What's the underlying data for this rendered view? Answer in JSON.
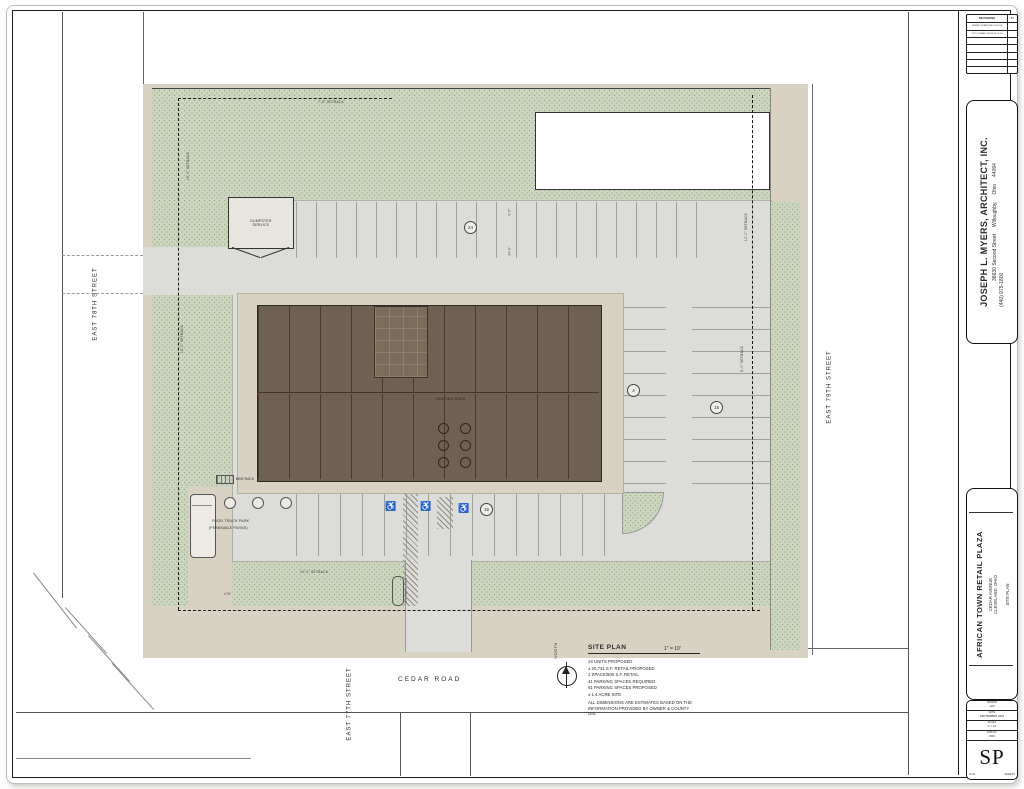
{
  "revisions": {
    "title": "REVISIONS",
    "by": "BY",
    "rows": [
      "PERMIT SUBMITTAL 01.05.24",
      "CITY CORRECTIONS 02.10.24",
      "",
      "",
      "",
      "",
      ""
    ]
  },
  "architect": {
    "name": "JOSEPH L. MYERS, ARCHITECT, INC.",
    "street": "38630 Second Street",
    "city": "Willoughby,",
    "state": "Ohio",
    "zip": "44094",
    "phone": "(440) 975-1800"
  },
  "project": {
    "name": "AFRICAN TOWN RETAIL PLAZA",
    "addr1": "CEDAR AVENUE",
    "addr2": "CLEVELAND, OHIO",
    "sheet_title": "SITE PLAN"
  },
  "sheetblock": {
    "rows": [
      {
        "label": "DRAWN",
        "value": "JLM"
      },
      {
        "label": "DATE",
        "value": "SEPTEMBER 2023"
      },
      {
        "label": "SCALE",
        "value": "1\" = 10'"
      },
      {
        "label": "JOB NO.",
        "value": "2310"
      }
    ],
    "number": "SP",
    "footer_left": "01 01",
    "footer_right": "SHEETS"
  },
  "plan": {
    "streets": {
      "left": "EAST 78TH STREET",
      "right": "EAST 79TH STREET",
      "south": "EAST 77TH STREET",
      "bottom": "CEDAR ROAD"
    },
    "labels": {
      "dumpster1": "DUMPSTER",
      "dumpster2": "SERVICE",
      "seating": "SEATING AREA",
      "bike_rack": "BIKE RACK",
      "food1": "FOOD TRUCK PARK",
      "food2": "(PERMEABLE PAVING)",
      "north": "NORTH",
      "monument": "MONUMENT SIGN"
    },
    "setbacks": {
      "top": "7'-0\" SETBACK",
      "left_upper": "15'-0\" SETBACK",
      "left_lower": "15'-0\" SETBACK",
      "right_upper": "12'-0\" SETBACK",
      "right_mid": "8'-0\" SETBACK",
      "bottom": "12'-0\" SETBACK"
    },
    "dims": {
      "stall": "9'-0\"",
      "aisle": "24'-0\"",
      "frontage": "±78'"
    },
    "counts": {
      "top": "24",
      "inner": "4",
      "east": "15",
      "south": "19"
    }
  },
  "notes": {
    "title": "SITE PLAN",
    "scale": "1\" = 10'",
    "lines": [
      "24 UNITS PROPOSED",
      "± 20,731 S.F. RETAIL PROPOSED",
      "1 SPACE/500 S.F. RETAIL",
      "41 PARKING SPACES REQUIRED",
      "61 PARKING SPACES PROPOSED",
      "± 1.4 ACRE SITE"
    ],
    "disclaimer": "ALL DIMENSIONS ARE ESTIMATES BASED ON THE INFORMATION PROVIDED BY OWNER & COUNTY GIS."
  },
  "colors": {
    "landscape": "#ccd6bf",
    "walkway": "#d8d2c2",
    "asphalt": "#dcdcd8",
    "building": "#6e6151"
  }
}
